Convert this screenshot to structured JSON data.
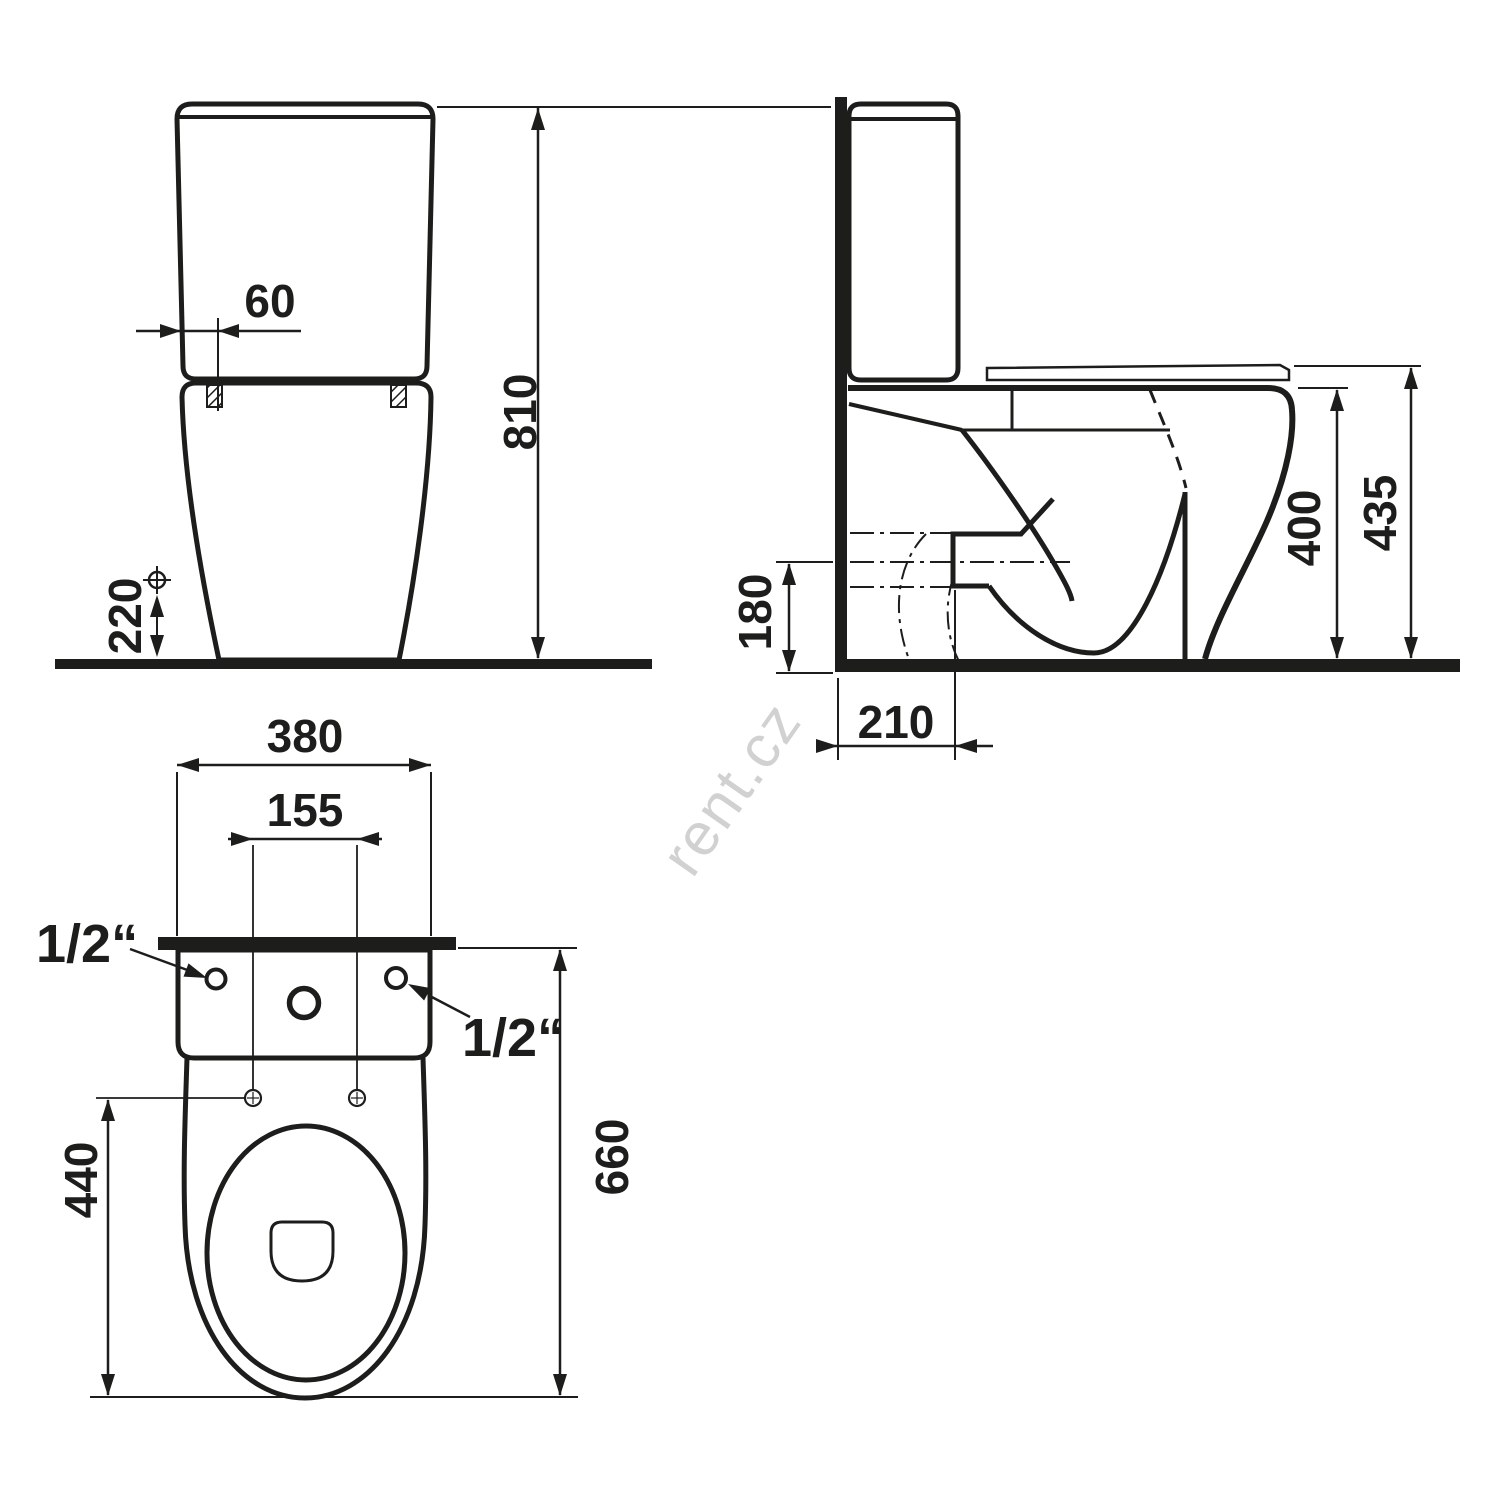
{
  "watermark": {
    "text": "rent.cz"
  },
  "front_view": {
    "dim_cistern_offset": "60",
    "dim_total_height": "810",
    "dim_inlet_height": "220"
  },
  "side_view": {
    "dim_outlet_height": "180",
    "dim_outlet_distance": "210",
    "dim_rim_height": "400",
    "dim_seat_height": "435"
  },
  "plan_view": {
    "dim_cistern_width": "380",
    "dim_holes_spacing": "155",
    "label_inlet_left": "1/2“",
    "label_inlet_right": "1/2“",
    "dim_bowl_length": "440",
    "dim_total_depth": "660"
  },
  "colors": {
    "ink": "#1d1d1b",
    "watermark": "#c9c9c9",
    "background": "#ffffff"
  }
}
